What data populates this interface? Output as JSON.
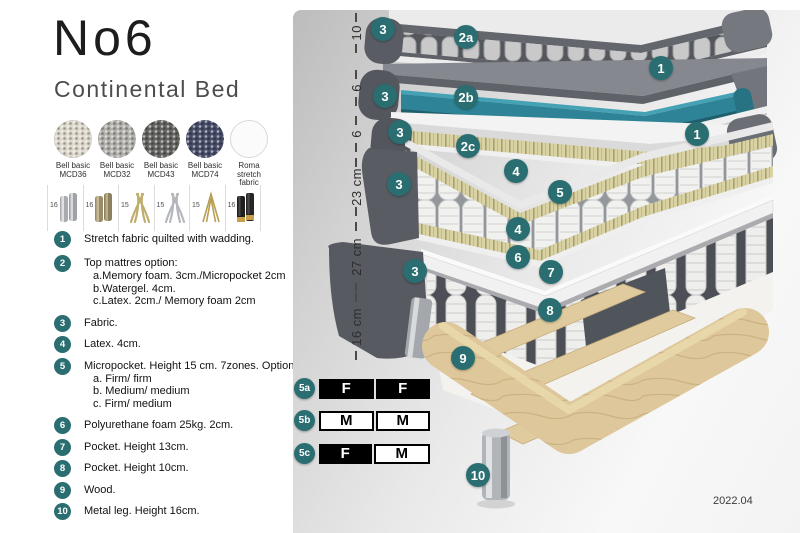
{
  "header": {
    "title": "No6",
    "subtitle": "Continental Bed"
  },
  "fabric_swatches": [
    {
      "name": "Bell basic MCD36",
      "lines": [
        "Bell basic",
        "MCD36"
      ],
      "color": "#ddd8cc",
      "texture": true
    },
    {
      "name": "Bell basic MCD32",
      "lines": [
        "Bell basic",
        "MCD32"
      ],
      "color": "#b2b0ab",
      "texture": true
    },
    {
      "name": "Bell basic MCD43",
      "lines": [
        "Bell basic",
        "MCD43"
      ],
      "color": "#646461",
      "texture": true
    },
    {
      "name": "Bell basic MCD74",
      "lines": [
        "Bell basic",
        "MCD74"
      ],
      "color": "#474d68",
      "texture": true
    },
    {
      "name": "Roma stretch fabric",
      "lines": [
        "Roma",
        "stretch fabric"
      ],
      "color": "#fbfbfb",
      "texture": false
    }
  ],
  "leg_options": [
    {
      "height": "16",
      "type": "cylinder-silver"
    },
    {
      "height": "16",
      "type": "cylinder-bronze"
    },
    {
      "height": "15",
      "type": "splayed-gold"
    },
    {
      "height": "15",
      "type": "splayed-silver"
    },
    {
      "height": "15",
      "type": "hairpin-gold"
    },
    {
      "height": "16",
      "type": "cylinder-black-gold"
    }
  ],
  "legend": [
    {
      "num": "1",
      "text": "Stretch fabric quilted with wadding.",
      "sub": []
    },
    {
      "num": "2",
      "text": "Top mattres option:",
      "sub": [
        "a.Memory foam. 3cm./Micropocket 2cm",
        "b.Watergel. 4cm.",
        "c.Latex. 2cm./ Memory foam 2cm"
      ]
    },
    {
      "num": "3",
      "text": "Fabric.",
      "sub": []
    },
    {
      "num": "4",
      "text": "Latex. 4cm.",
      "sub": []
    },
    {
      "num": "5",
      "text": "Micropocket. Height 15 cm. 7zones. Option:",
      "sub": [
        "a. Firm/ firm",
        "b. Medium/ medium",
        "c. Firm/ medium"
      ]
    },
    {
      "num": "6",
      "text": "Polyurethane foam 25kg. 2cm.",
      "sub": []
    },
    {
      "num": "7",
      "text": "Pocket. Height 13cm.",
      "sub": []
    },
    {
      "num": "8",
      "text": "Pocket. Height 10cm.",
      "sub": []
    },
    {
      "num": "9",
      "text": "Wood.",
      "sub": []
    },
    {
      "num": "10",
      "text": "Metal leg. Height 16cm.",
      "sub": []
    }
  ],
  "diagram": {
    "dimensions": [
      {
        "label": "10",
        "top": 3,
        "height": 40
      },
      {
        "label": "6",
        "top": 60,
        "height": 36
      },
      {
        "label": "6",
        "top": 106,
        "height": 36
      },
      {
        "label": "23 cm",
        "top": 148,
        "height": 58
      },
      {
        "label": "27 cm",
        "top": 212,
        "height": 70
      },
      {
        "label": "16 cm",
        "top": 283,
        "height": 67
      }
    ],
    "badges": [
      {
        "label": "3",
        "x": 90,
        "y": 19
      },
      {
        "label": "2a",
        "x": 173,
        "y": 27
      },
      {
        "label": "1",
        "x": 368,
        "y": 58
      },
      {
        "label": "3",
        "x": 92,
        "y": 86
      },
      {
        "label": "2b",
        "x": 173,
        "y": 87
      },
      {
        "label": "3",
        "x": 107,
        "y": 122
      },
      {
        "label": "2c",
        "x": 175,
        "y": 136
      },
      {
        "label": "1",
        "x": 404,
        "y": 124
      },
      {
        "label": "3",
        "x": 106,
        "y": 174
      },
      {
        "label": "4",
        "x": 223,
        "y": 161
      },
      {
        "label": "5",
        "x": 267,
        "y": 182
      },
      {
        "label": "4",
        "x": 225,
        "y": 219
      },
      {
        "label": "6",
        "x": 225,
        "y": 247
      },
      {
        "label": "3",
        "x": 122,
        "y": 261
      },
      {
        "label": "7",
        "x": 258,
        "y": 262
      },
      {
        "label": "8",
        "x": 257,
        "y": 300
      },
      {
        "label": "9",
        "x": 170,
        "y": 348
      },
      {
        "label": "10",
        "x": 185,
        "y": 465
      }
    ],
    "firmness_rows": [
      {
        "badge": "5a",
        "top": 368,
        "cells": [
          {
            "text": "F",
            "style": "dark"
          },
          {
            "text": "F",
            "style": "dark"
          }
        ]
      },
      {
        "badge": "5b",
        "top": 400,
        "cells": [
          {
            "text": "M",
            "style": "light"
          },
          {
            "text": "M",
            "style": "light"
          }
        ]
      },
      {
        "badge": "5c",
        "top": 433,
        "cells": [
          {
            "text": "F",
            "style": "dark"
          },
          {
            "text": "M",
            "style": "light"
          }
        ]
      }
    ],
    "version": "2022.04"
  },
  "colors": {
    "badge_teal": "#2b6e72",
    "watergel_teal": "#2e8496",
    "table_black": "#000000"
  }
}
